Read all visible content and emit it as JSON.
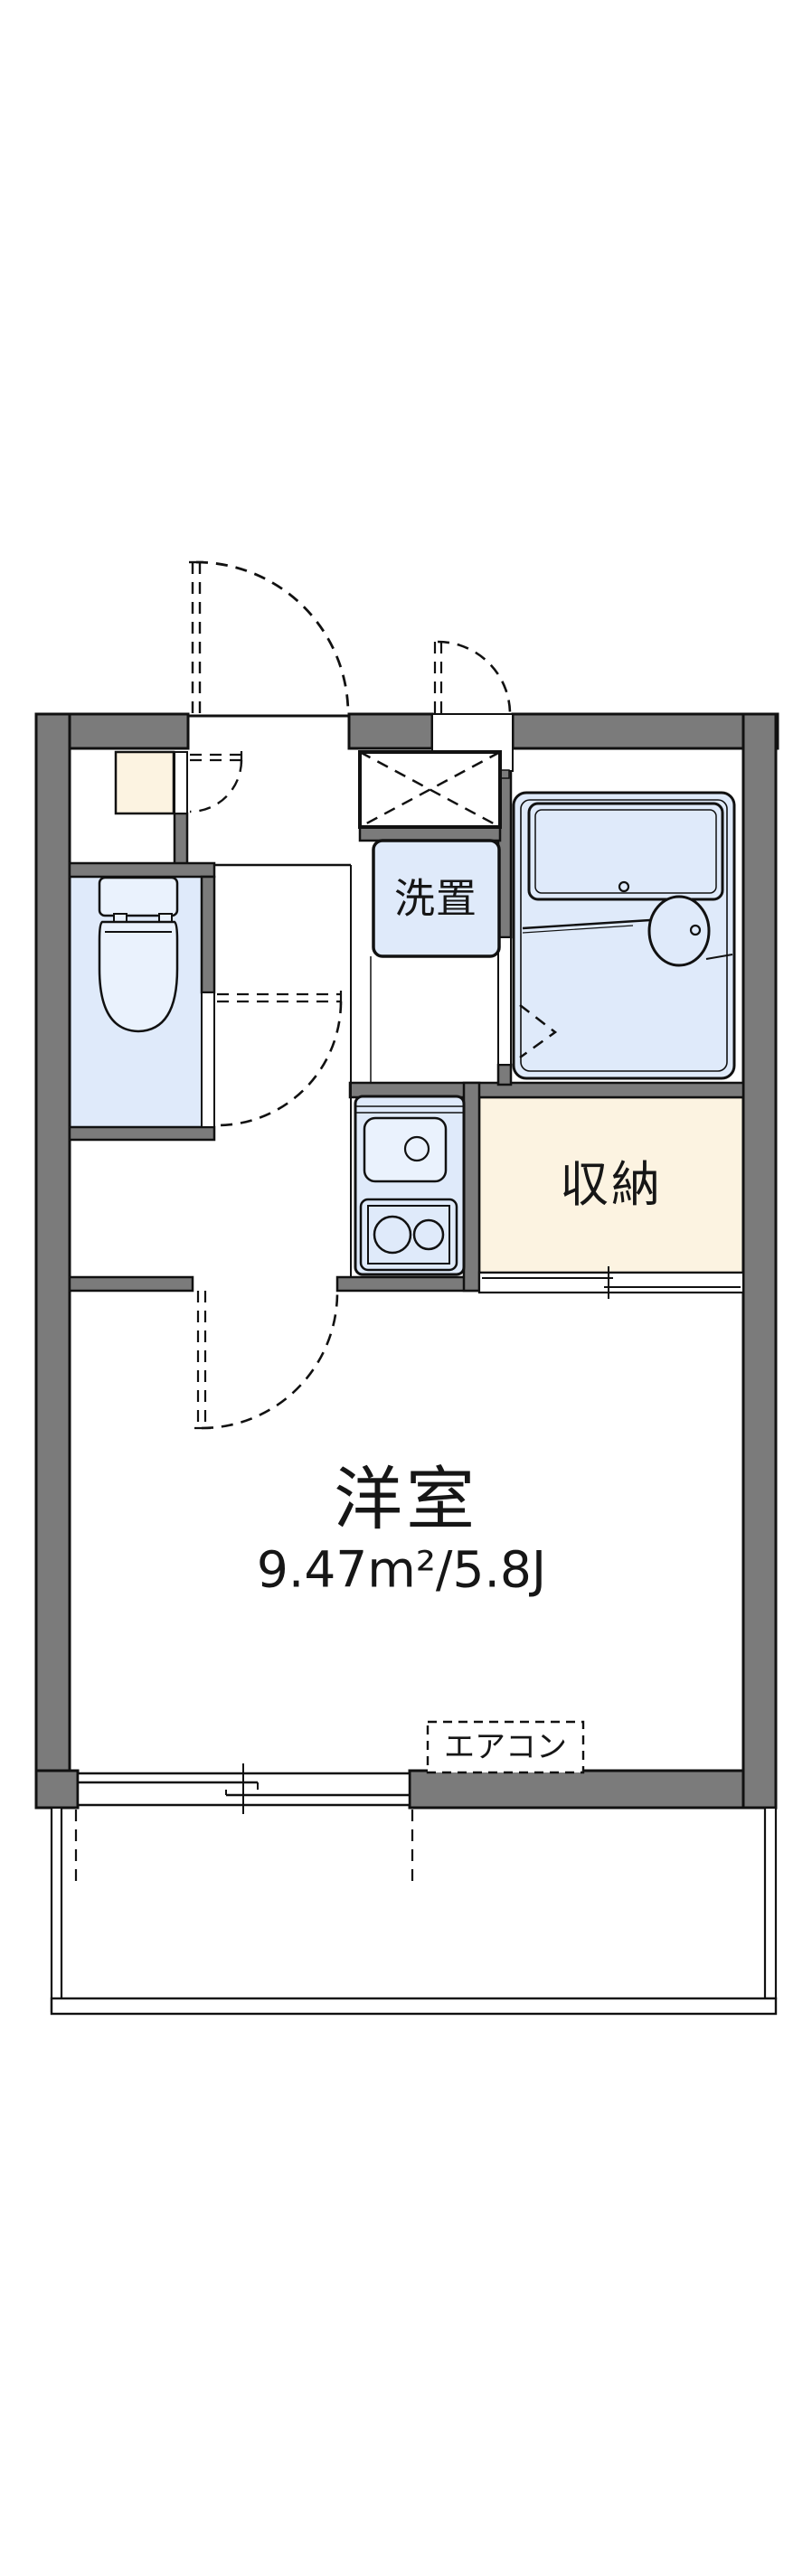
{
  "floorplan": {
    "rooms": {
      "laundry": {
        "name": "洗置"
      },
      "closet": {
        "name": "収納"
      },
      "western_room": {
        "name": "洋室",
        "size": "9.47m²/5.8J"
      },
      "aircon": {
        "name": "エアコン"
      }
    },
    "colors": {
      "wall": "#7b7b7b",
      "line": "#111111",
      "blue": "#dfeafa",
      "blue2": "#eaf2fd",
      "cream": "#fcf3e1",
      "white": "#ffffff"
    }
  }
}
